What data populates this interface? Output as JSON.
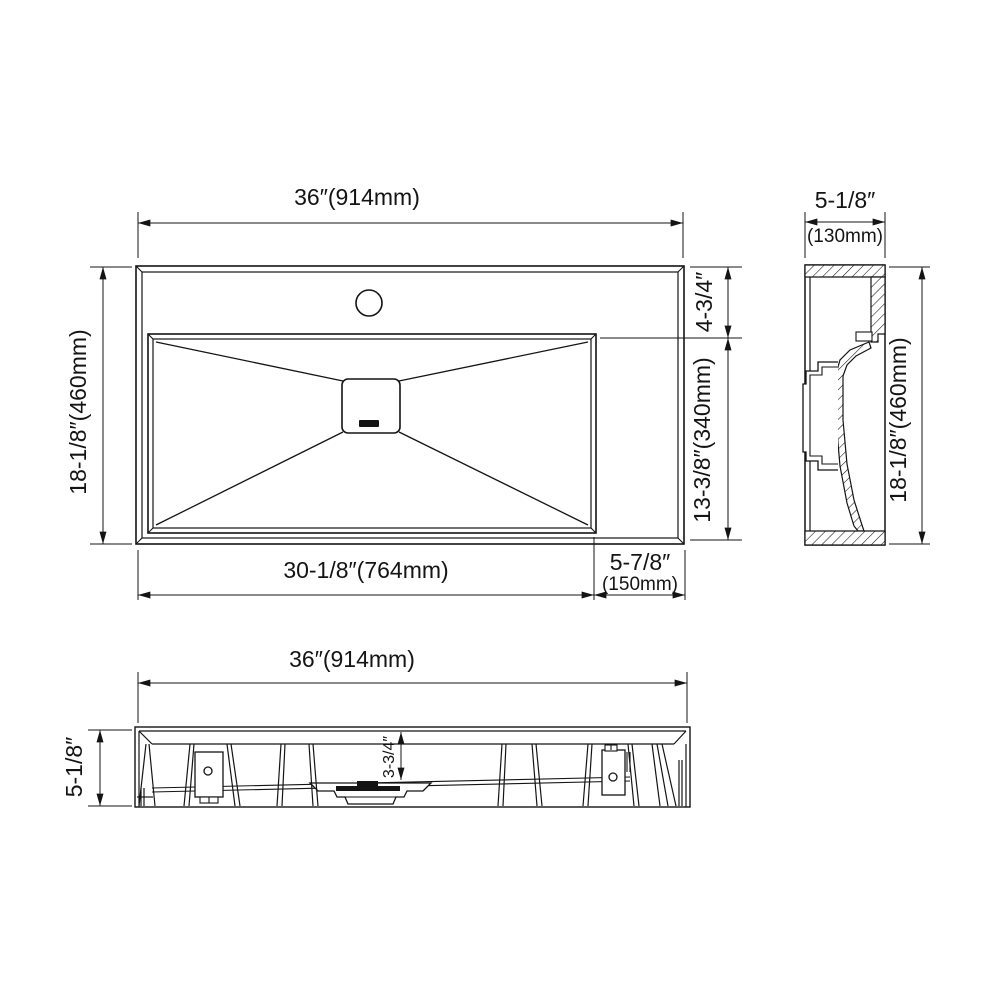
{
  "drawing": {
    "type": "bathroom-sink-technical-drawing",
    "line_color": "#141414",
    "background": "#ffffff"
  },
  "dims": {
    "plan_width": "36″(914mm)",
    "plan_height": "18-1/8″(460mm)",
    "deck_depth": "4-3/4″",
    "basin_depth": "13-3/8″(340mm)",
    "basin_width": "30-1/8″(764mm)",
    "right_deck_width": "5-7/8″",
    "right_deck_width_mm": "(150mm)",
    "side_width": "5-1/8″",
    "side_width_mm": "(130mm)",
    "side_height": "18-1/8″(460mm)",
    "front_width": "36″(914mm)",
    "front_height": "5-1/8″",
    "drain_drop": "3-3/4″"
  }
}
